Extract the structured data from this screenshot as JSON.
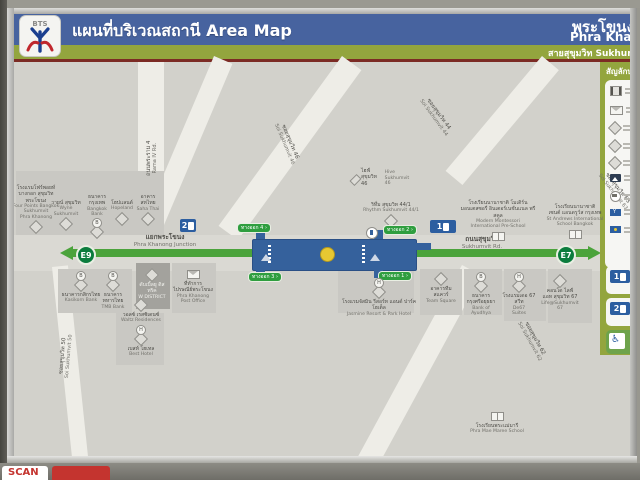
{
  "header": {
    "logo_brand": "BTS",
    "title_th": "แผนที่บริเวณสถานี",
    "title_en": "Area Map",
    "station_th": "พระโขนง",
    "station_en": "Phra Khanong",
    "line_name": "สายสุขุมวิท Sukhumvit Line"
  },
  "colors": {
    "header_blue": "#47639f",
    "header_green": "#93a53e",
    "bts_line_green": "#4ba33b",
    "station_marker_green": "#0b7c3d",
    "station_blue": "#35619c",
    "exit_green": "#2f9e3f",
    "map_bg": "#d2d1cb",
    "scan_red": "#c4342f"
  },
  "map": {
    "line_markers": {
      "west": "E9",
      "east": "E7"
    },
    "junction": {
      "th": "แยกพระโขนง",
      "en": "Phra Khanong Junction"
    },
    "sukhumvit_rd": {
      "th": "ถนนสุขุมวิท",
      "en": "Sukhumvit Rd."
    },
    "rama4_rd": {
      "th": "ถนนพระราม 4",
      "en": "Rama IV Rd."
    },
    "soi_labels": [
      {
        "th": "ซอยสุขุมวิท 46",
        "en": "Soi Sukhumvit 46",
        "x": 247,
        "y": 75,
        "rot": 67
      },
      {
        "th": "ซอยสุขุมวิท 44",
        "en": "Soi Sukhumvit 44",
        "x": 396,
        "y": 48,
        "rot": 54
      },
      {
        "th": "ซอยสุขุมวิท 63",
        "en": "Soi Sukhumvit 63",
        "x": 575,
        "y": 122,
        "rot": 52
      },
      {
        "th": "ซอยสุขุมวิท 50",
        "en": "Soi Sukhumvit 50",
        "x": 26,
        "y": 288,
        "rot": -85
      },
      {
        "th": "ซอยสุขุมวิท 62",
        "en": "Soi Sukhumvit 62",
        "x": 492,
        "y": 272,
        "rot": 61
      }
    ],
    "exits": [
      {
        "label": "ทางออก 4",
        "x": 224,
        "y": 162
      },
      {
        "label": "ทางออก 2",
        "x": 370,
        "y": 164
      },
      {
        "label": "ทางออก 3",
        "x": 235,
        "y": 211
      },
      {
        "label": "ทางออก 1",
        "x": 365,
        "y": 210
      }
    ],
    "exit_markers": [
      {
        "n": "2",
        "x": 166,
        "y": 157,
        "w": 16
      },
      {
        "n": "1",
        "x": 416,
        "y": 158,
        "w": 26
      }
    ],
    "places": [
      {
        "th": "โรงแรมโฟร์พอยท์\nบางกอก สุขุมวิท\nพระโขนง",
        "en": "Four Points Bangkok\nSukhumvit\nPhra Khanong",
        "icon": "diamond",
        "ipos": "below",
        "x": 22,
        "y": 123,
        "w": 52
      },
      {
        "th": "วายน์ สุขุมวิท",
        "en": "Wyne\nSukhumvit",
        "icon": "diamond",
        "ipos": "below",
        "x": 52,
        "y": 138,
        "w": 34
      },
      {
        "th": "ธนาคาร\nกรุงเทพ",
        "en": "Bangkok\nBank",
        "icon": "diamond-b",
        "ipos": "below",
        "x": 83,
        "y": 132,
        "w": 30
      },
      {
        "th": "โฮปแลนด์",
        "en": "Hopeland",
        "icon": "diamond",
        "ipos": "below",
        "x": 108,
        "y": 138,
        "w": 30
      },
      {
        "th": "อาคาร\nสหไทย",
        "en": "Saha Thai",
        "icon": "diamond",
        "ipos": "below",
        "x": 134,
        "y": 132,
        "w": 28
      },
      {
        "th": "ไฮฟ์ สุขุมวิท 46",
        "en": "Hive Sukhumvit 46",
        "icon": "diamond",
        "ipos": "left",
        "x": 368,
        "y": 106,
        "w": 60
      },
      {
        "th": "ริทึ่ม สุขุมวิท 44/1",
        "en": "Rhythm Sukhumvit 44/1",
        "icon": "diamond",
        "ipos": "below",
        "x": 377,
        "y": 140,
        "w": 60
      },
      {
        "th": "โรงเรียนนานาชาติ โมเดิร์น\nมอนเตสซอรี่ อินเตอร์เนชั่นแนล พรีสคูล",
        "en": "Modern Montessori\nInternational Pre-School",
        "icon": "school",
        "ipos": "below",
        "x": 484,
        "y": 138,
        "w": 80
      },
      {
        "th": "โรงเรียนนานาชาติ\nเซนต์ แอนดรูว์ส กรุงเทพ",
        "en": "St Andrews International\nSchool Bangkok",
        "icon": "school",
        "ipos": "below",
        "x": 561,
        "y": 142,
        "w": 70
      },
      {
        "th": "ธนาคารกสิกรไทย",
        "en": "Kasikorn Bank",
        "icon": "diamond-b",
        "ipos": "above",
        "x": 67,
        "y": 209,
        "w": 44
      },
      {
        "th": "ธนาคาร\nทหารไทย",
        "en": "TMB Bank",
        "icon": "diamond-b",
        "ipos": "above",
        "x": 99,
        "y": 209,
        "w": 32
      },
      {
        "th": "ดับเบิ้ลยู ดิสทริค",
        "en": "W DISTRICT",
        "icon": "diamond",
        "ipos": "above",
        "x": 138,
        "y": 206,
        "w": 34,
        "light": true
      },
      {
        "th": "ที่ทำการ\nไปรษณีย์พระโขนง",
        "en": "Phra Khanong\nPost Office",
        "icon": "envelope",
        "ipos": "above",
        "x": 179,
        "y": 206,
        "w": 44
      },
      {
        "th": "วอลซ์ เรสซิเดนซ์",
        "en": "Waltz Residences",
        "icon": "diamond",
        "ipos": "above",
        "x": 127,
        "y": 236,
        "w": 44
      },
      {
        "th": "เบสท์ โฮเทล",
        "en": "Best Hotel",
        "icon": "circle-h",
        "ipos": "above",
        "x": 127,
        "y": 263,
        "w": 40
      },
      {
        "th": "โรงแรมจัสมิน รีสอร์ท แอนด์ ปาร์ค โฮเต็ล",
        "en": "Jasmine Resort & Park Hotel",
        "icon": "circle-h",
        "ipos": "above",
        "x": 365,
        "y": 216,
        "w": 82
      },
      {
        "th": "อาคารทีม\nสแควร์",
        "en": "Team Square",
        "icon": "diamond",
        "ipos": "above",
        "x": 427,
        "y": 210,
        "w": 34
      },
      {
        "th": "ธนาคาร\nกรุงศรีอยุธยา",
        "en": "Bank of Ayudhya",
        "icon": "diamond-b",
        "ipos": "above",
        "x": 467,
        "y": 210,
        "w": 38
      },
      {
        "th": "โรงแรมเดอ 67\nสวีท",
        "en": "De67\nSuites",
        "icon": "circle-h",
        "ipos": "above",
        "x": 505,
        "y": 210,
        "w": 34
      },
      {
        "th": "คอนโด ไลฟ์\nแอท สุขุมวิท 67",
        "en": "Life@Sukhumvit 67",
        "icon": "diamond",
        "ipos": "above",
        "x": 546,
        "y": 212,
        "w": 42
      },
      {
        "th": "โรงเรียนพระแม่มารี",
        "en": "Phra Mae Maree School",
        "icon": "school",
        "ipos": "above",
        "x": 483,
        "y": 348,
        "w": 64
      }
    ]
  },
  "legend": {
    "title": "สัญลักษณ์",
    "items": [
      {
        "icon": "postbox-icon"
      },
      {
        "icon": "post-office-envelope-icon"
      },
      {
        "icon": "bank-diamond-icon"
      },
      {
        "icon": "building-diamond-icon"
      },
      {
        "icon": "hotel-diamond-icon"
      },
      {
        "icon": "landmark-photo-icon"
      },
      {
        "icon": "bus-stop-icon"
      },
      {
        "icon": "blue-flag-icon"
      },
      {
        "icon": "blue-sign-icon"
      }
    ],
    "exit_rows": [
      {
        "n": "1"
      },
      {
        "n": "2"
      }
    ],
    "lift_row": {
      "icon": "wheelchair-lift-icon"
    }
  },
  "sticker": {
    "text": "SCAN"
  }
}
